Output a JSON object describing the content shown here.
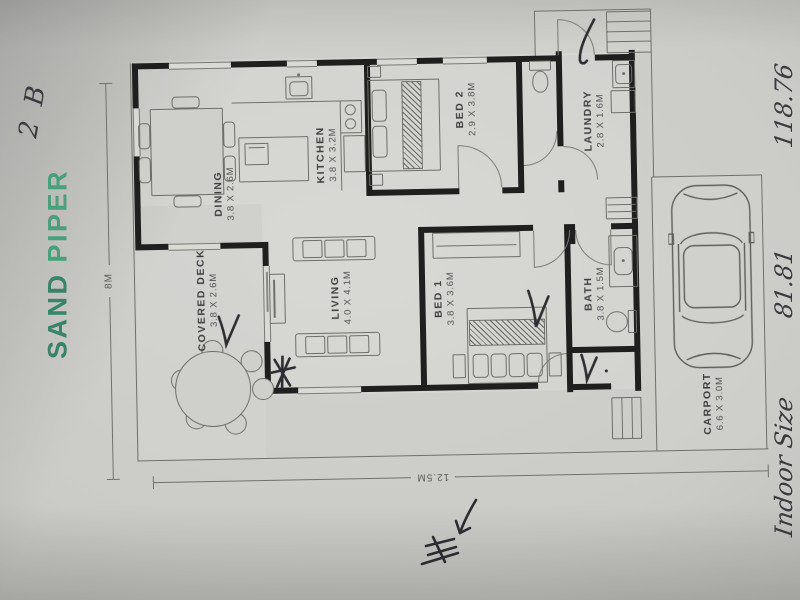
{
  "brand": {
    "word1": "SAND",
    "word2": "PIPER"
  },
  "handwriting": {
    "bedroom_code": "2 B",
    "edge_fragment_1": "Indoor Size",
    "edge_fragment_2": "81.81",
    "edge_fragment_3": "118.76"
  },
  "rooms": [
    {
      "name": "DINING",
      "dims": "3.8 X 2.6M"
    },
    {
      "name": "KITCHEN",
      "dims": "3.8 X 3.2M"
    },
    {
      "name": "BED 2",
      "dims": "2.9 X 3.8M"
    },
    {
      "name": "LAUNDRY",
      "dims": "2.8 X 1.6M"
    },
    {
      "name": "COVERED DECK",
      "dims": "3.8 X 2.6M"
    },
    {
      "name": "LIVING",
      "dims": "4.0 X 4.1M"
    },
    {
      "name": "BED 1",
      "dims": "3.8 X 3.6M"
    },
    {
      "name": "BATH",
      "dims": "3.8 X 1.5M"
    },
    {
      "name": "CARPORT",
      "dims": "6.6 X 3.0M"
    }
  ],
  "dimensions": {
    "width_label": "12.5M",
    "height_label": "8M"
  },
  "annotations": {
    "pen_checkmarks": 4,
    "pen_star": 1,
    "north_arrow_sketch": 1
  },
  "colors": {
    "brand_green_dark": "#37846a",
    "brand_green_light": "#49a07b",
    "paper": "#cbcbc7",
    "wall": "#1f1f1f",
    "pen_ink": "#2c2c32",
    "line_gray": "#71716c"
  }
}
